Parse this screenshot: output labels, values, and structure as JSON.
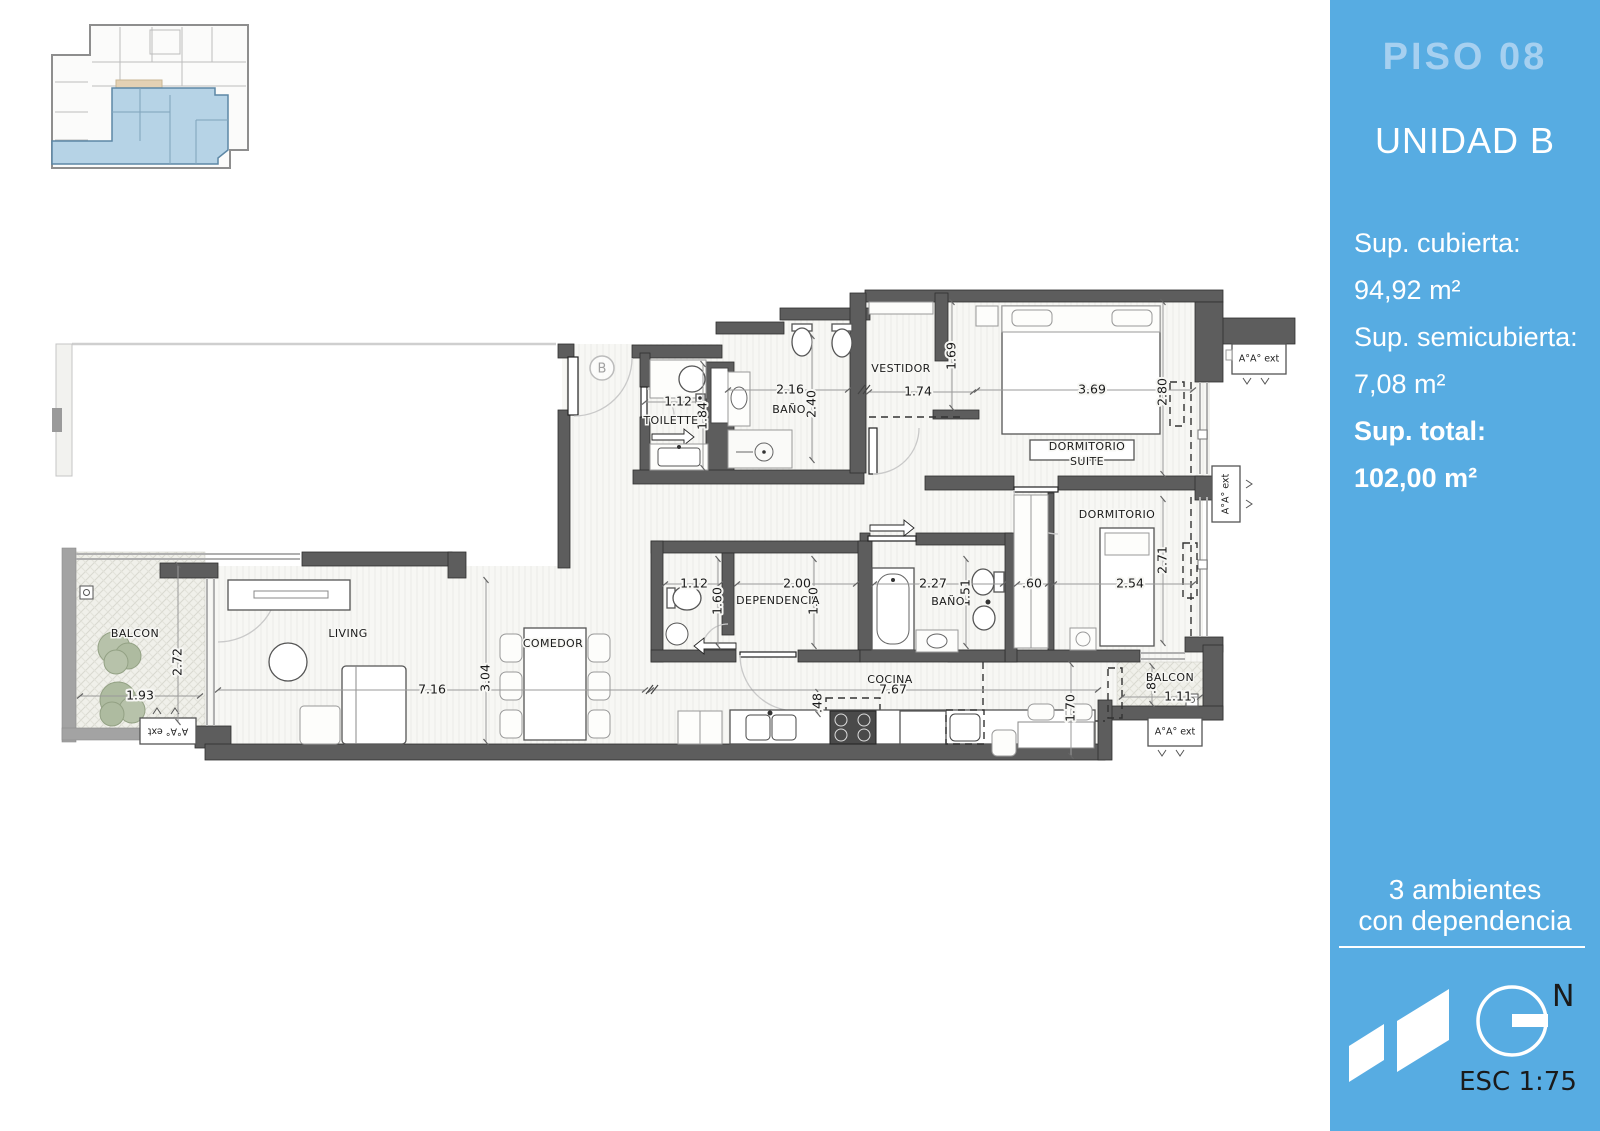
{
  "sidebar": {
    "accent": "#57ace2",
    "floor": "PISO 08",
    "unit": "UNIDAD B",
    "stats": [
      {
        "label": "Sup. cubierta:",
        "value": "94,92 m²"
      },
      {
        "label": "Sup. semicubierta:",
        "value": "7,08 m²"
      },
      {
        "label": "Sup. total:",
        "value": "102,00 m²"
      }
    ],
    "typology": [
      "3 ambientes",
      "con dependencia"
    ],
    "north_label": "N",
    "scale_label": "ESC 1:75"
  },
  "plan": {
    "entrance_marker": "B",
    "rooms": [
      "BALCON",
      "LIVING",
      "COMEDOR",
      "TOILETTE",
      "BAÑO",
      "VESTIDOR",
      "DORMITORIO",
      "SUITE",
      "DORMITORIO",
      "DEPENDENCIA",
      "BAÑO",
      "COCINA",
      "BALCON"
    ],
    "dims": [
      "1.93",
      "2.72",
      "7.16",
      "3.04",
      "7.67",
      ".48",
      "1.12",
      "1.84",
      "2.16",
      "2.40",
      "1.74",
      "1.69",
      "3.69",
      "2.80",
      "1.12",
      "1.60",
      "2.00",
      "1.60",
      "2.27",
      "1.51",
      ".60",
      "2.54",
      "2.71",
      "1.70",
      "1.11",
      ".81"
    ],
    "ac_units": [
      "A°A° ext",
      "A°A° ext",
      "A°A° ext",
      "A°A° ext"
    ]
  }
}
